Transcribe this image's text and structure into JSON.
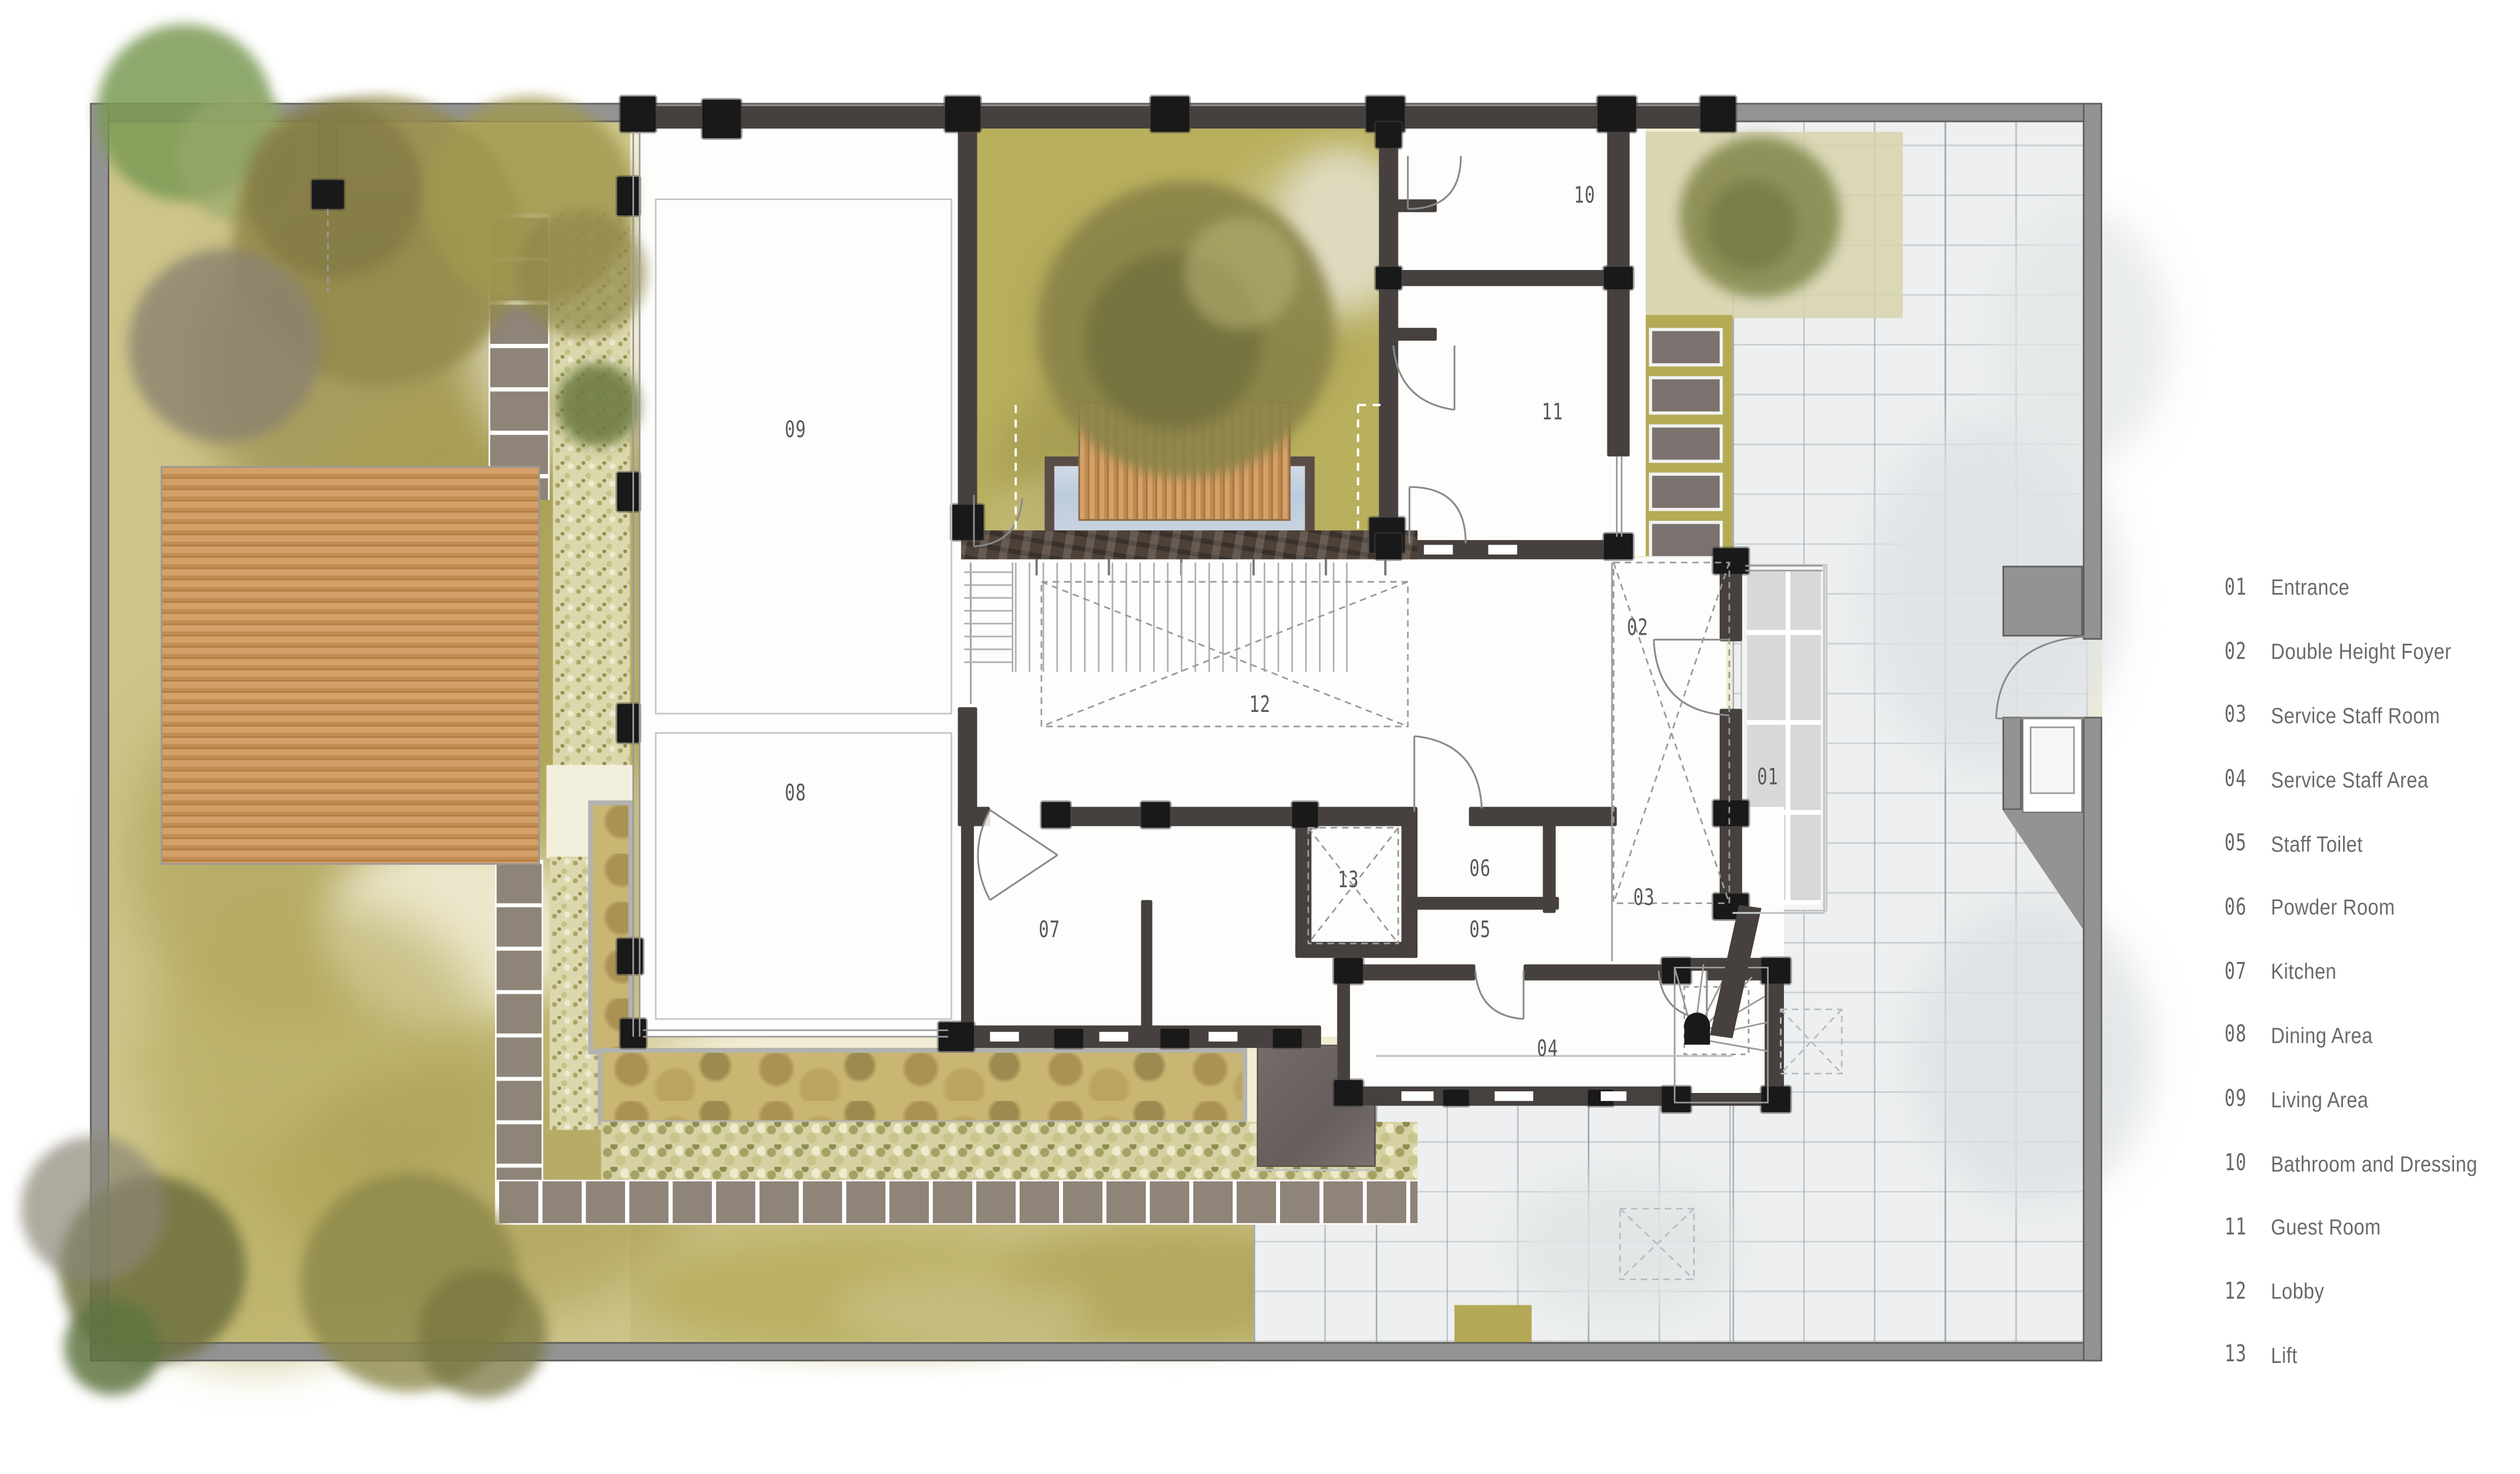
{
  "document": {
    "type": "architectural floor plan",
    "view": "ground floor plan with landscaped site"
  },
  "rooms": [
    {
      "number": "01",
      "label": "Entrance"
    },
    {
      "number": "02",
      "label": "Double Height Foyer"
    },
    {
      "number": "03",
      "label": "Service Staff Room"
    },
    {
      "number": "04",
      "label": "Service Staff Area"
    },
    {
      "number": "05",
      "label": "Staff Toilet"
    },
    {
      "number": "06",
      "label": "Powder Room"
    },
    {
      "number": "07",
      "label": "Kitchen"
    },
    {
      "number": "08",
      "label": "Dining Area"
    },
    {
      "number": "09",
      "label": "Living Area"
    },
    {
      "number": "10",
      "label": "Bathroom and Dressing"
    },
    {
      "number": "11",
      "label": "Guest Room"
    },
    {
      "number": "12",
      "label": "Lobby"
    },
    {
      "number": "13",
      "label": "Lift"
    }
  ],
  "colors": {
    "wall": "#46413e",
    "column": "#191919",
    "site_boundary": "#939393",
    "lawn_olive": "#b3a95c",
    "paper_cream": "#f1ecd3",
    "wood_deck": "#c28c52",
    "pool_water": "#bccbdc",
    "stone_band": "#4e4138",
    "pavement": "#edeff0",
    "stepping_paver": "#8e8478",
    "legend_text": "#6a6a6a"
  }
}
